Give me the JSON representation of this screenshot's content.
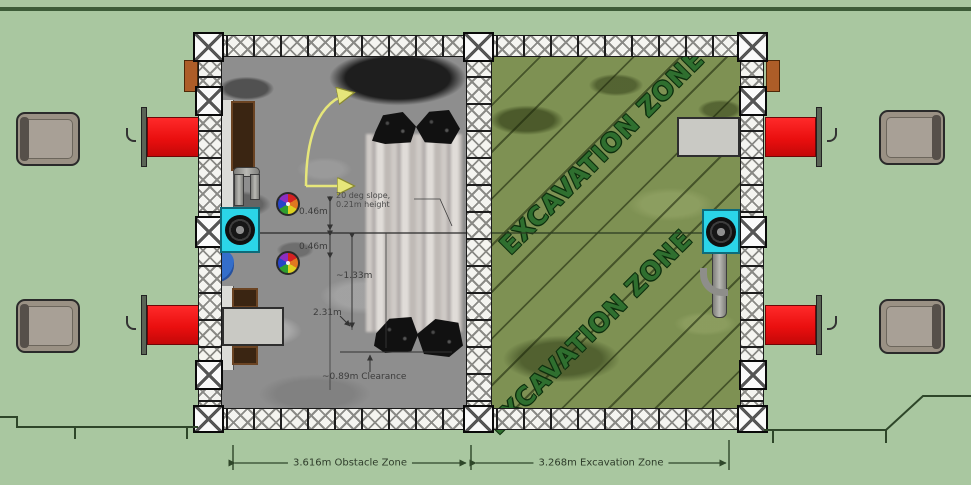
{
  "diagram": {
    "obstacle_zone": {
      "dimension_label": "3.616m Obstacle Zone",
      "slope_note_line1": "20 deg slope,",
      "slope_note_line2": "0.21m height",
      "dim_top": "0.46m",
      "dim_mid": "0.46m",
      "dim_width": "~1.33m",
      "dim_length": "2.31m",
      "clearance_label": "~0.89m Clearance"
    },
    "excavation_zone": {
      "dimension_label": "3.268m Excavation Zone",
      "watermark": "EXCAVATION ZONE"
    },
    "colors": {
      "background_green": "#a9c7a0",
      "moon_gray": "#8e8e8e",
      "excavation_green": "#7e9153",
      "table_red": "#ea0f0f",
      "fan_box_cyan": "#2bd5e8",
      "bin_brown": "#3a2512",
      "peg_orange": "#ad5d28",
      "truss_white": "#f4f4f0",
      "outline_dark_green": "#2e4629",
      "arrow_yellow": "#d8d860"
    }
  }
}
